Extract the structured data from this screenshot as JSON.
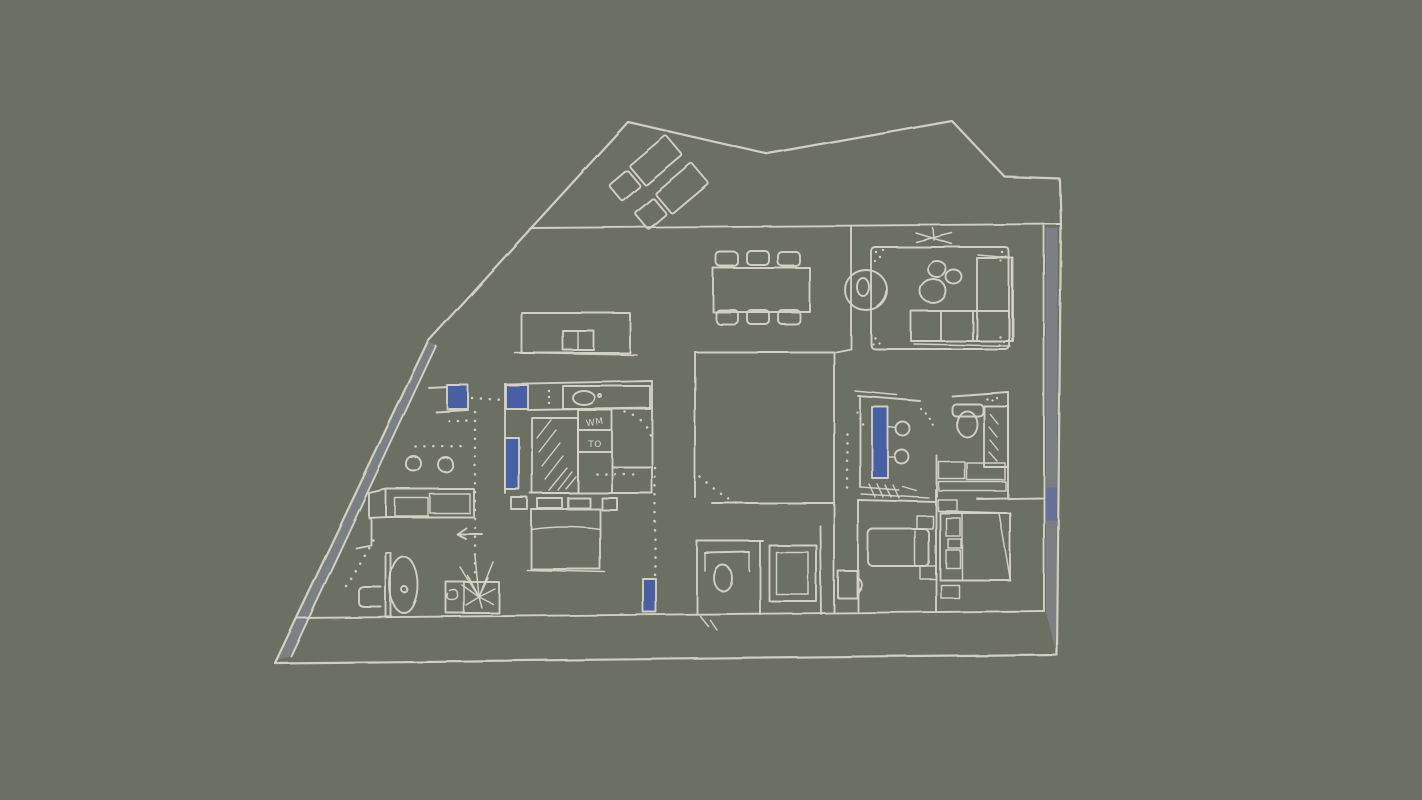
{
  "meta": {
    "title": "Hand-drawn apartment floor plan sketch",
    "type": "floor-plan-sketch"
  },
  "palette": {
    "background": "#6B7063",
    "line": "#D7D4C6",
    "wall_shade": "#7C8084",
    "accent_blue": "#4A5EA3",
    "accent_blue_soft": "#5E6C9E"
  },
  "labels": {
    "washing_machine": "WM",
    "tumble_dryer": "TO"
  },
  "elements": [
    "site-boundary",
    "terrace-band",
    "sun-lounger",
    "sun-lounger",
    "living-room-rug",
    "l-shaped-sofa",
    "round-armchair",
    "coffee-tables",
    "tv-mark",
    "dining-table",
    "dining-chairs",
    "console-sideboard",
    "kitchen-counter",
    "hob-burners",
    "kitchen-island",
    "laundry-wardrobe-block",
    "mirrored-closet",
    "washing-machine",
    "tumble-dryer",
    "sink-counter",
    "double-bed",
    "single-bed",
    "double-bed",
    "master-bathroom",
    "vanity-basins",
    "toilet",
    "shower",
    "central-bedroom-box",
    "wc-room",
    "shower-cabin",
    "door-leaf",
    "oval-table",
    "plant-box",
    "direction-arrow",
    "blue-window-marks",
    "blue-door-mark",
    "door-swing-dots"
  ]
}
